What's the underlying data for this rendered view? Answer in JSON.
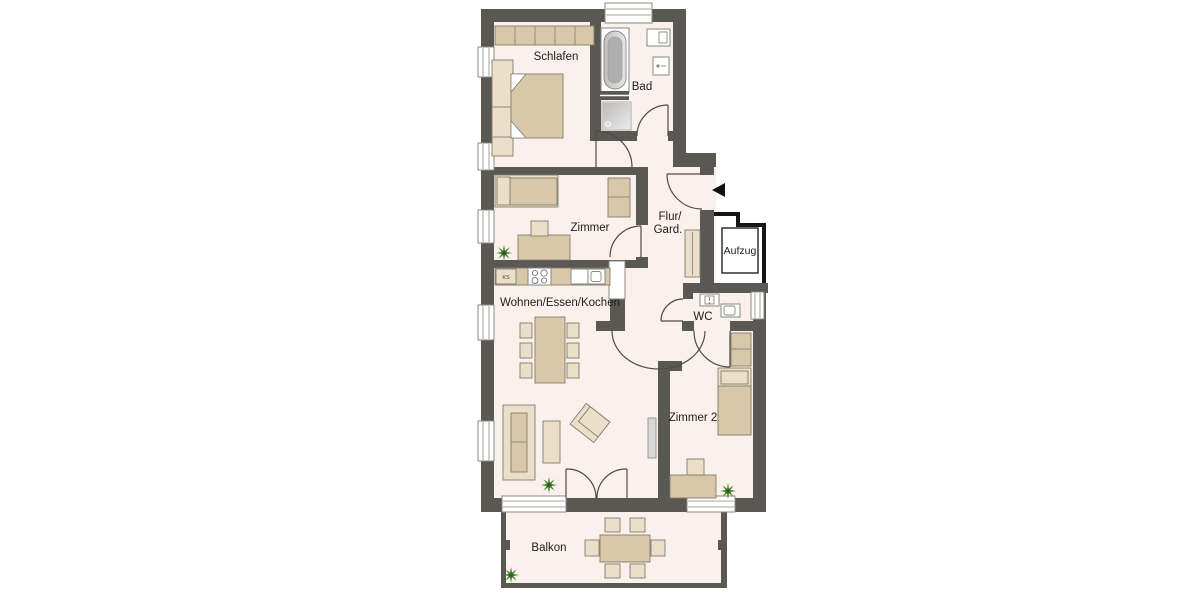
{
  "title": "Wohnungsgrundriss (apartment floor plan)",
  "colors": {
    "wall": "#5a5853",
    "floor": "#faf0ec",
    "furn": "#d9c7a9",
    "furn_light": "#ecdfc9",
    "furn_border": "#817e6b",
    "fixture_border": "#8a887f",
    "line": "#4e4c47",
    "stair": "#161616",
    "plant": "#3d7c27",
    "plant_center": "#2c5e1c",
    "text": "#1d1d1b"
  },
  "labels": {
    "schlafen": "Schlafen",
    "bad": "Bad",
    "zimmer": "Zimmer",
    "flur_line1": "Flur/",
    "flur_line2": "Gard.",
    "aufzug": "Aufzug",
    "wohnen": "Wohnen/Essen/Kochen",
    "wc": "WC",
    "zimmer2": "Zimmer 2",
    "balkon": "Balkon",
    "ks": "KS"
  }
}
